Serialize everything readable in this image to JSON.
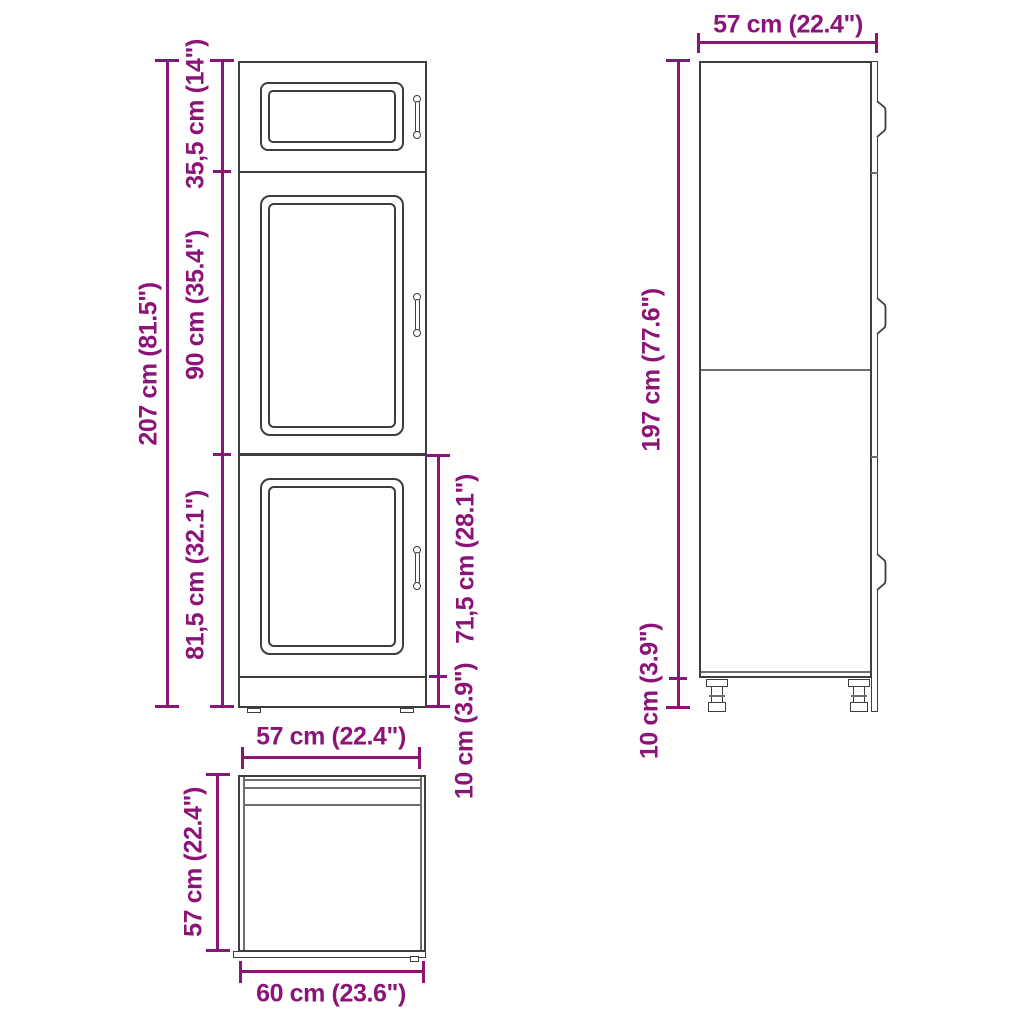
{
  "colors": {
    "accent": "#8C1478",
    "line": "#3E3E3E",
    "thin_line": "#6E6E6E"
  },
  "front_view": {
    "total_height": "207 cm (81.5\")",
    "top_section_height": "35,5 cm (14\")",
    "middle_section_height": "90 cm (35.4\")",
    "bottom_section_height": "81,5 cm (32.1\")",
    "bottom_door_height": "71,5 cm (28.1\")",
    "plinth_height": "10 cm (3.9\")",
    "width": "57 cm (22.4\")"
  },
  "side_view": {
    "depth": "57 cm (22.4\")",
    "body_height": "197 cm (77.6\")",
    "leg_height": "10 cm (3.9\")"
  },
  "top_view": {
    "depth": "57 cm (22.4\")",
    "front_width": "60 cm (23.6\")"
  }
}
